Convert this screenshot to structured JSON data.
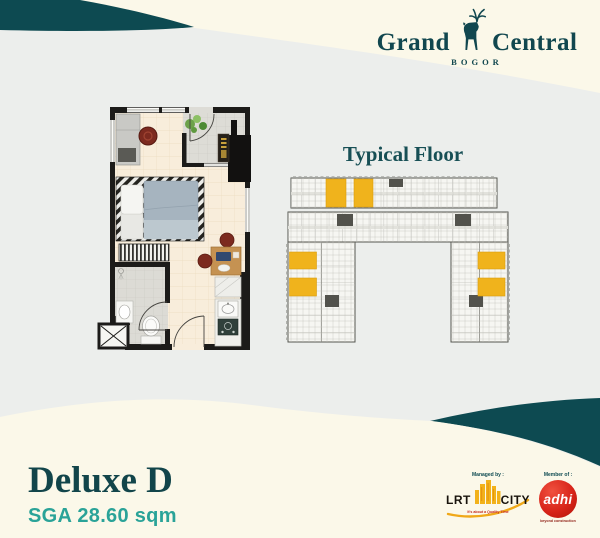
{
  "colors": {
    "background_gray": "#eceeec",
    "cream": "#fbf8e9",
    "teal_dark": "#0d4a51",
    "teal_heading": "#174f55",
    "teal_accent": "#2aa398",
    "highlight_yellow": "#f0b31c",
    "lrt_yellow": "#f2b21a",
    "adhi_red": "#d8251a"
  },
  "logo": {
    "word1": "Grand",
    "word2": "Central",
    "city": "BOGOR",
    "icon": "deer-icon"
  },
  "typical_floor": {
    "title": "Typical Floor",
    "highlighted_units_count": 6
  },
  "unit": {
    "name": "Deluxe D",
    "area": "SGA 28.60 sqm"
  },
  "footer": {
    "managed_by_label": "Managed by :",
    "member_of_label": "Member of :",
    "lrt_city": {
      "name_left": "LRT",
      "name_right": "CITY",
      "tagline": "It's about a Quality Time",
      "icon": "city-skyline-icon"
    },
    "adhi": {
      "wordmark": "adhi",
      "tagline": "beyond construction"
    }
  }
}
